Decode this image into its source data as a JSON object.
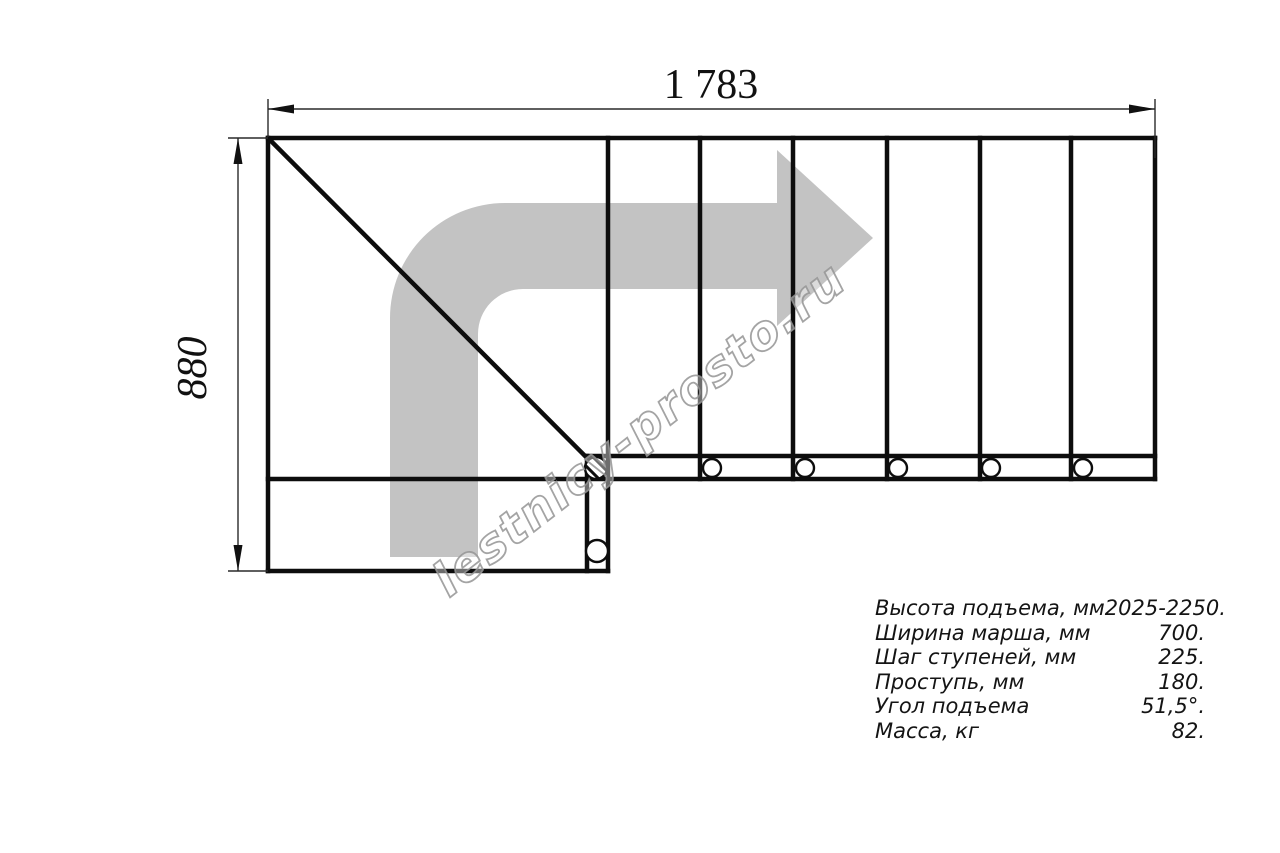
{
  "drawing": {
    "title": "staircase-plan-blueprint",
    "dim_width_label": "1 783",
    "dim_height_label": "880",
    "watermark": "lestnicy-prosto.ru",
    "icons": {
      "direction_arrow": "bent-right-block-arrow",
      "bolt_marks": "small-circles-on-stringer"
    },
    "colors": {
      "background": "#ffffff",
      "line": "#0d0d0d",
      "arrow_gray": "#c3c3c3",
      "watermark_gray": "#a6a6a6"
    }
  },
  "spec_table": {
    "rows": [
      {
        "label": "Высота подъема, мм",
        "value": "2025-2250."
      },
      {
        "label": "Ширина марша, мм",
        "value": "700."
      },
      {
        "label": "Шаг ступеней, мм",
        "value": "225."
      },
      {
        "label": "Проступь, мм",
        "value": "180."
      },
      {
        "label": "Угол подъема",
        "value": "51,5°."
      },
      {
        "label": "Масса, кг",
        "value": "82."
      }
    ]
  }
}
